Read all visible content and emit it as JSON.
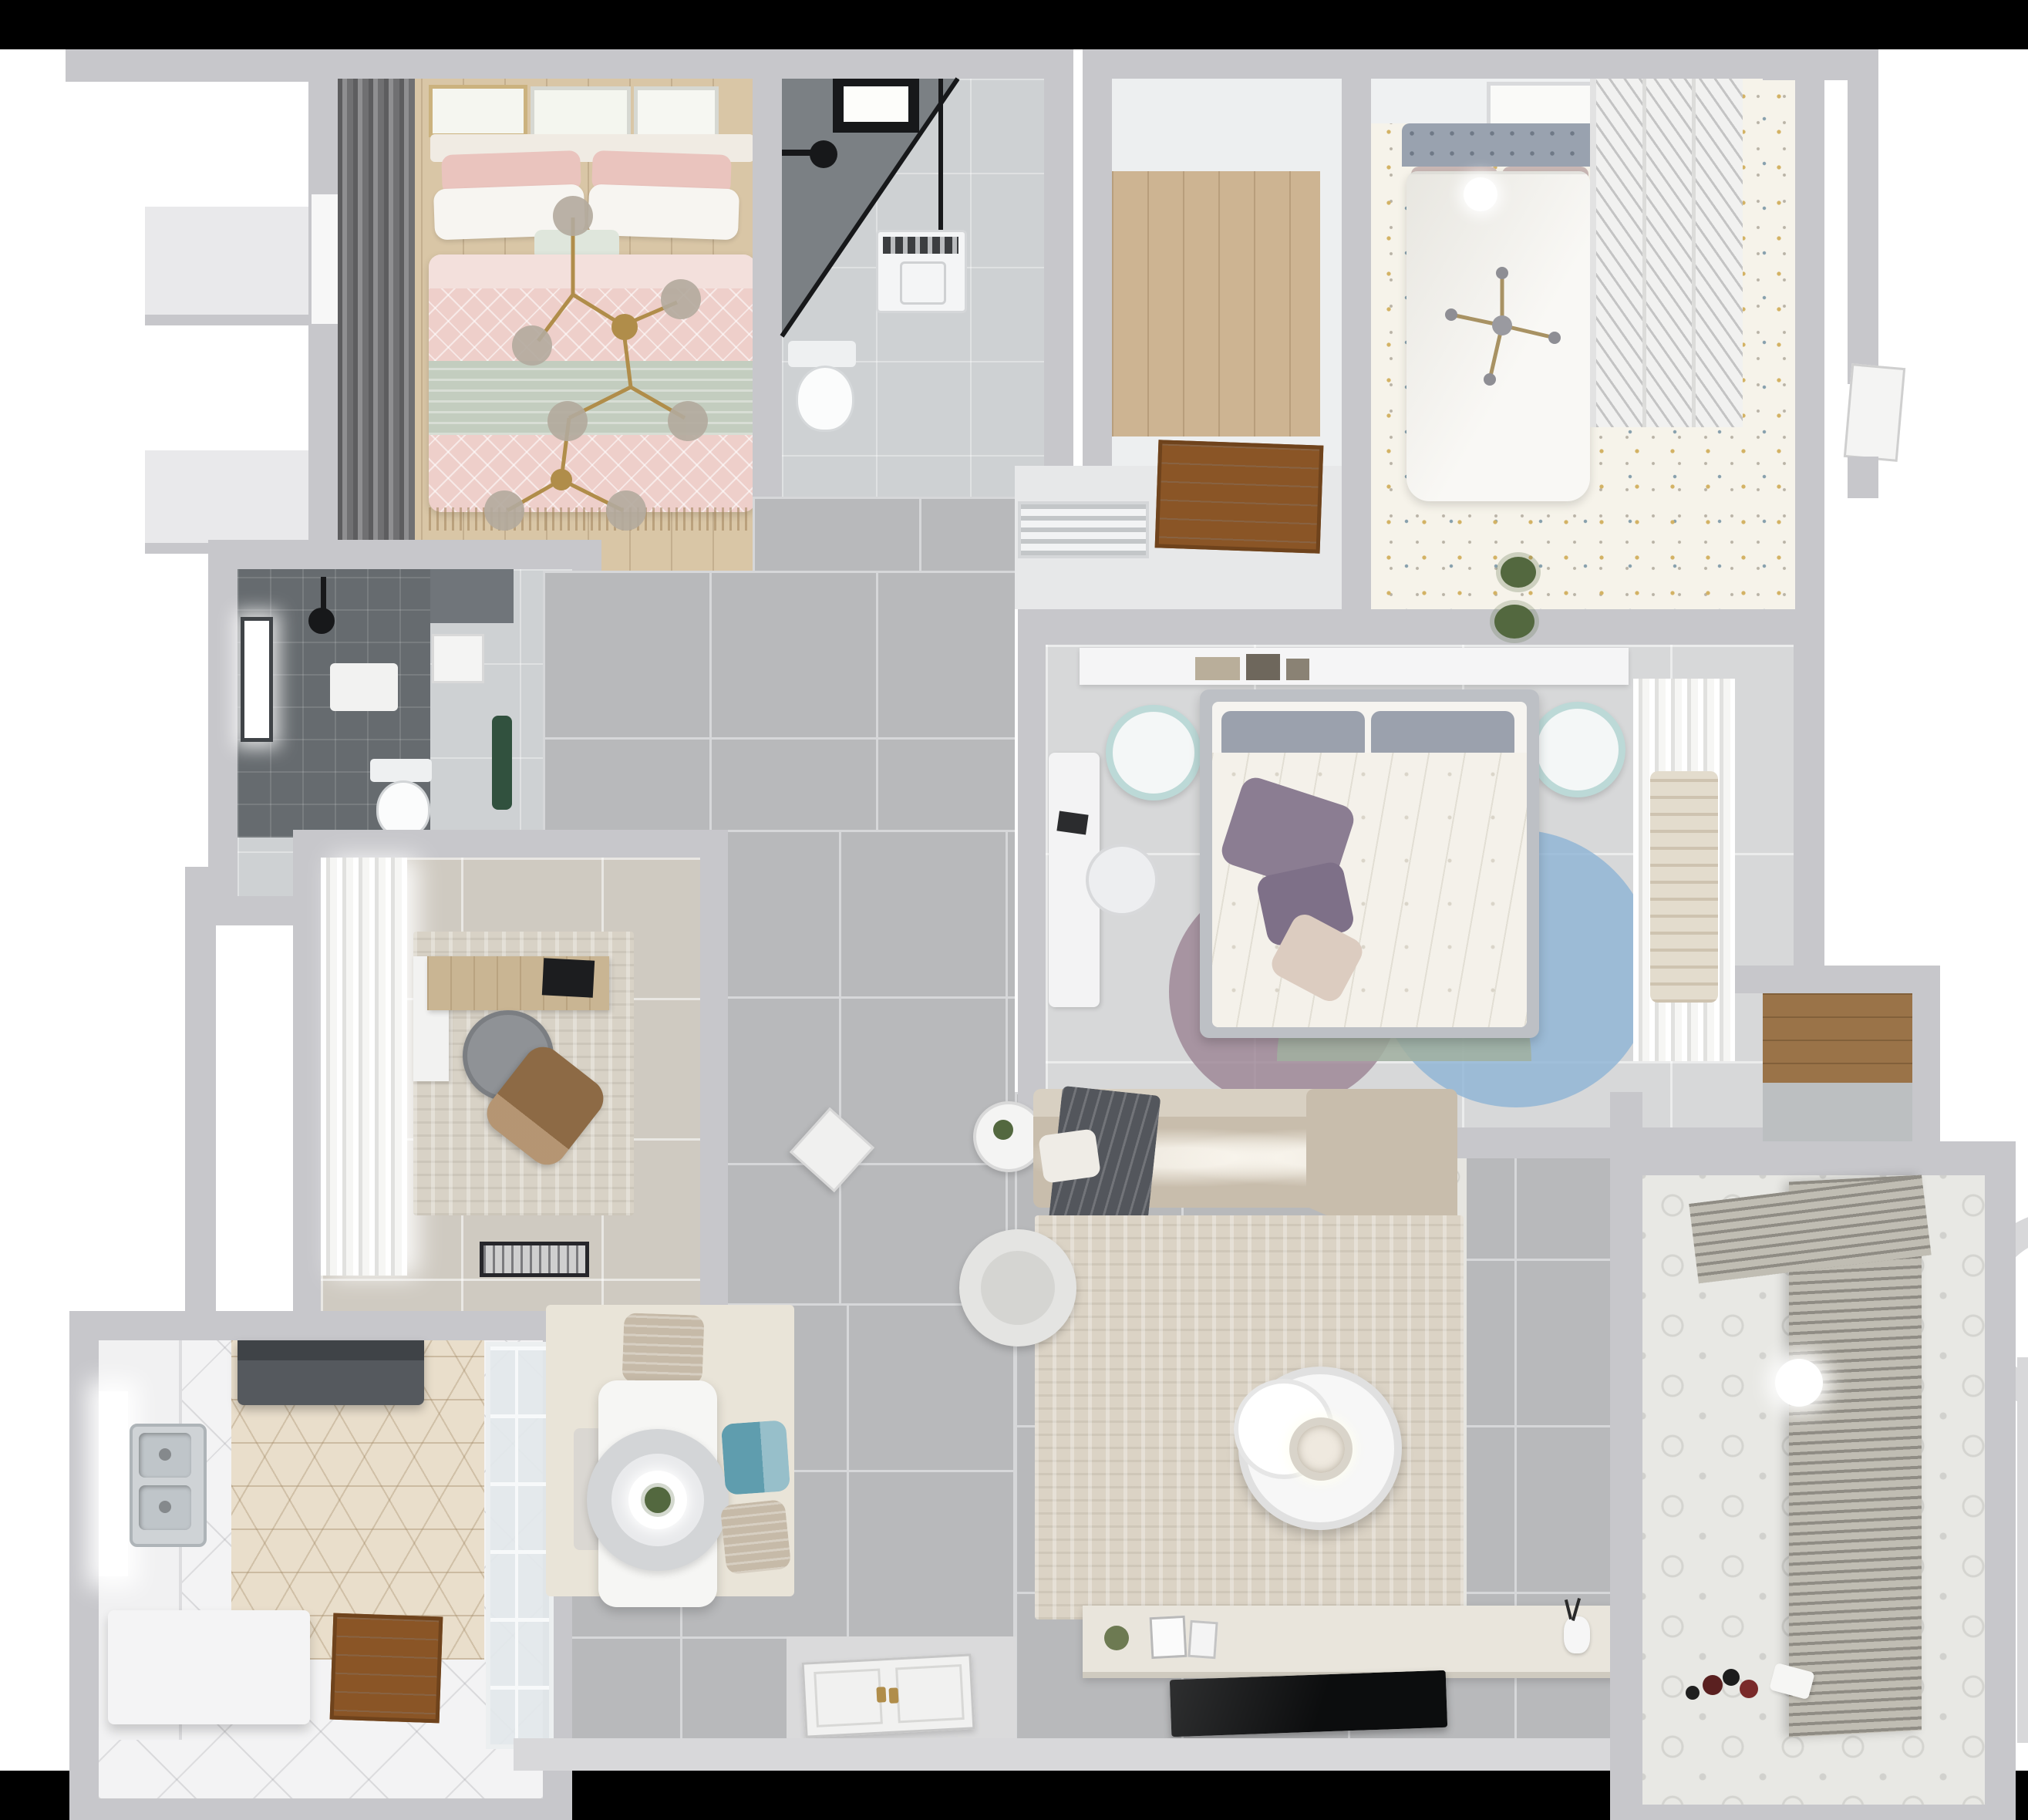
{
  "scene": {
    "type": "3d-rendered-floorplan",
    "view": "top-down dollhouse render of an apartment",
    "letterbox_bars": "black strips across the full top and bottom edges"
  },
  "palette": {
    "background": "#ffffff",
    "letterbox": "#000000",
    "wall": "#c7c7cb",
    "wall_light": "#d8d8da",
    "wall_dark": "#b0b0b4",
    "inner_white": "#eceded",
    "tile_gray": "#b8b9bb",
    "tile_grout": "#d6d7d9",
    "tile_warm": "#cfcac1",
    "floor_master": "#d7d8d9",
    "floor_marble": "#ced1d3",
    "wood_floor": "#d9c6a6",
    "wood_closet": "#cdb492",
    "wood_door": "#8a5526",
    "wood_shelf": "#9a7348",
    "desk_wood": "#c9b593",
    "rug_living": "#dbd3c5",
    "rug_dining": "#e9e4d8",
    "rug_study": "#d8d2c6",
    "sofa": "#c8bdac",
    "sofa_light": "#d8d0c2",
    "throw_dark": "#53565c",
    "duvet_pink": "#eecfca",
    "pillow_pink": "#eac4be",
    "sage": "#c3cdbf",
    "linen_white": "#f7f5f1",
    "headboard_blue": "#99a2af",
    "pillow_mauve": "#c9b7b4",
    "bed_white": "#f9f8f5",
    "terrazzo": "#f6f3ea",
    "shower_dark": "#7b8084",
    "bath_dark": "#666b6f",
    "black_fixture": "#17181a",
    "teal_chair": "#5f9dae",
    "teal_light": "#bcd9d7",
    "chair_beige": "#c6baa8",
    "pillow_purple": "#8b7d92",
    "rug_blue": "#8fb4d6",
    "rug_mauve": "#9c8595",
    "rug_sage": "#a1b0a0",
    "gold": "#b08d4a",
    "glass_globe": "#b0a89c",
    "plant_green": "#53683f",
    "accent_green": "#31513e",
    "hex_tile": "#e9decb",
    "hex_line": "#c3ad8d",
    "balcony_floor": "#e8e8e4",
    "blinds": "#8f8c84",
    "blinds_light": "#c0bdb3",
    "console": "#e9e5dc",
    "tv_black": "#0c0d0e",
    "washer_white": "#f4f5f6"
  },
  "rooms": [
    {
      "id": "bedroom-pink",
      "label": "Bedroom with pink bedding",
      "furniture": [
        "double-bed",
        "pink-patterned-duvet",
        "sage-throw",
        "white-and-pink-pillows",
        "gold-branch-chandelier",
        "dark-curtains",
        "three-wall-art-frames",
        "wood-floor"
      ]
    },
    {
      "id": "bathroom-main",
      "label": "Bathroom with corner shower",
      "furniture": [
        "black-framed-glass-shower",
        "shower-head",
        "skylight-window",
        "washing-machine",
        "toilet"
      ]
    },
    {
      "id": "walk-in-closet",
      "label": "Walk-in room with wood floor",
      "furniture": [
        "wood-plank-floor"
      ]
    },
    {
      "id": "bedroom-top-right",
      "label": "Bedroom with white bed and terrazzo floor",
      "furniture": [
        "white-double-bed",
        "blue-gray-tufted-headboard",
        "mauve-pillows",
        "sphere-lamp",
        "gold-cross-chandelier",
        "louvered-wardrobe",
        "wall-art",
        "plant"
      ]
    },
    {
      "id": "bathroom-dark",
      "label": "Dark tiled shower room",
      "furniture": [
        "dark-tile-shower",
        "window",
        "black-shower-head",
        "bath-mat",
        "toilet",
        "green-plant"
      ]
    },
    {
      "id": "hallway",
      "label": "Hallway with gray tiles",
      "furniture": [
        "vent-grille",
        "wood-entry-door-top",
        "white-front-door-bottom",
        "white-side-chair"
      ]
    },
    {
      "id": "bedroom-center",
      "label": "Master bedroom",
      "furniture": [
        "gray-frame-bed",
        "floral-white-duvet",
        "purple-pillows",
        "headboard-shelf-with-books",
        "two-teal-stools",
        "white-desk-and-chair",
        "overlapping-circle-rug",
        "sheer-curtain-closet"
      ]
    },
    {
      "id": "study",
      "label": "Study",
      "furniture": [
        "sheer-curtains",
        "wood-desk",
        "monitor",
        "gray-office-chair",
        "brown-lounge-chair",
        "textured-rug",
        "door-mat"
      ]
    },
    {
      "id": "kitchen",
      "label": "Kitchen",
      "furniture": [
        "range-hood",
        "counter-with-window",
        "double-stainless-sink",
        "white-island",
        "hexagon-tile-floor",
        "wood-door",
        "glass-partition"
      ]
    },
    {
      "id": "dining",
      "label": "Dining area",
      "furniture": [
        "white-table",
        "ring-pendant-lamp",
        "plant-centerpiece",
        "beige-chair",
        "teal-chair",
        "second-beige-chair",
        "white-chair",
        "beige-rug"
      ]
    },
    {
      "id": "living",
      "label": "Living room",
      "furniture": [
        "l-shaped-sofa",
        "dark-gray-throw",
        "large-beige-rug",
        "round-nesting-coffee-table",
        "round-armchair",
        "side-table-with-plant",
        "tv-console-with-decor",
        "flat-tv",
        "patterned-tile-runner"
      ]
    },
    {
      "id": "balcony",
      "label": "Balcony / utility room",
      "furniture": [
        "venetian-blinds",
        "patterned-tile-floor",
        "white-sphere-lamp",
        "toys-on-floor"
      ]
    },
    {
      "id": "storage-niche",
      "label": "Storage niche with wood shelf",
      "furniture": [
        "wood-shelf"
      ]
    }
  ]
}
